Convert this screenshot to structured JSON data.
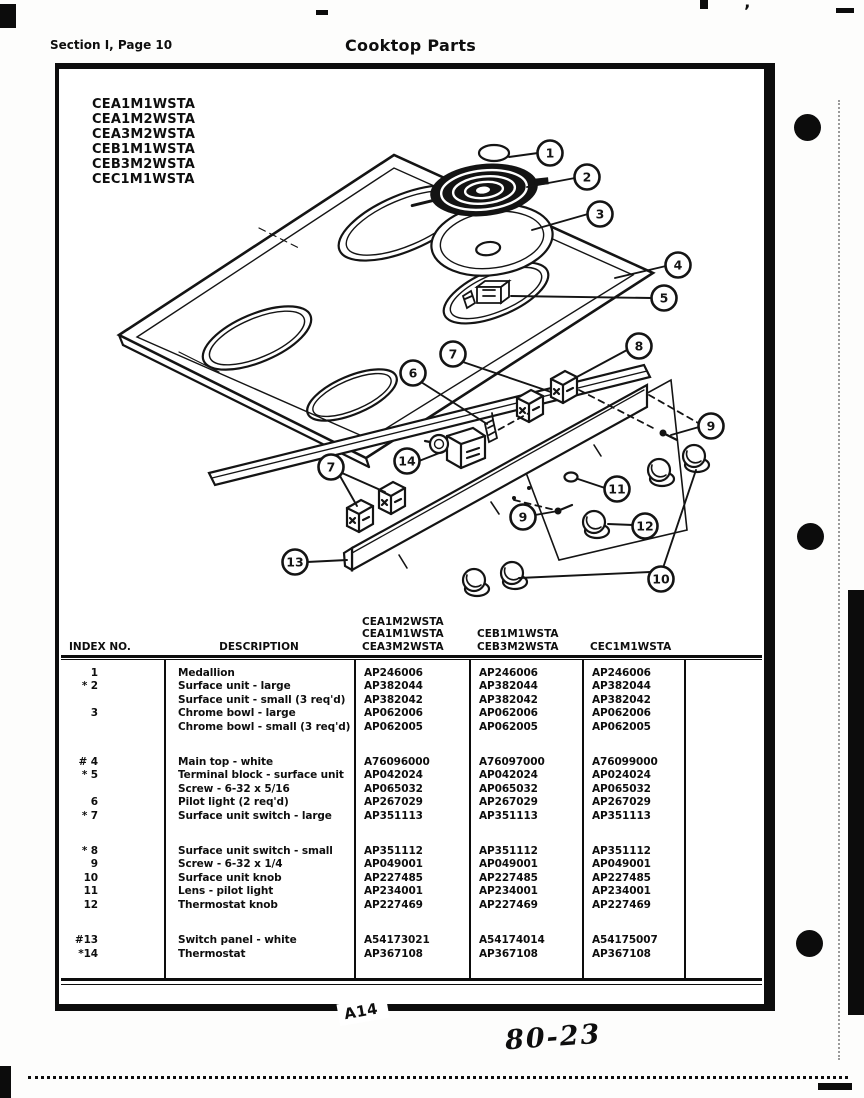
{
  "page": {
    "section_label": "Section I, Page 10",
    "title": "Cooktop Parts",
    "footer_label": "A14",
    "handwritten_note": "80-23"
  },
  "models": [
    "CEA1M1WSTA",
    "CEA1M2WSTA",
    "CEA3M2WSTA",
    "CEB1M1WSTA",
    "CEB3M2WSTA",
    "CEC1M1WSTA"
  ],
  "diagram": {
    "callouts": [
      {
        "label": "1"
      },
      {
        "label": "2"
      },
      {
        "label": "3"
      },
      {
        "label": "4"
      },
      {
        "label": "5"
      },
      {
        "label": "7"
      },
      {
        "label": "8"
      },
      {
        "label": "6"
      },
      {
        "label": "14"
      },
      {
        "label": "7"
      },
      {
        "label": "9"
      },
      {
        "label": "11"
      },
      {
        "label": "9"
      },
      {
        "label": "12"
      },
      {
        "label": "13"
      },
      {
        "label": "10"
      }
    ]
  },
  "table": {
    "headers": {
      "index": "INDEX NO.",
      "description": "DESCRIPTION",
      "col1_models": [
        "CEA1M2WSTA",
        "CEA1M1WSTA",
        "CEA3M2WSTA"
      ],
      "col2_models": [
        "CEB1M1WSTA",
        "CEB3M2WSTA"
      ],
      "col3_models": [
        "CEC1M1WSTA"
      ]
    },
    "groups": [
      {
        "rows": [
          {
            "index": "1",
            "description": "Medallion",
            "parts": [
              "AP246006",
              "AP246006",
              "AP246006"
            ]
          },
          {
            "index": "* 2",
            "description": "Surface unit - large",
            "parts": [
              "AP382044",
              "AP382044",
              "AP382044"
            ]
          },
          {
            "index": "",
            "description": "Surface unit - small (3 req'd)",
            "parts": [
              "AP382042",
              "AP382042",
              "AP382042"
            ]
          },
          {
            "index": "3",
            "description": "Chrome bowl - large",
            "parts": [
              "AP062006",
              "AP062006",
              "AP062006"
            ]
          },
          {
            "index": "",
            "description": "Chrome bowl - small (3 req'd)",
            "parts": [
              "AP062005",
              "AP062005",
              "AP062005"
            ]
          }
        ]
      },
      {
        "rows": [
          {
            "index": "# 4",
            "description": "Main top - white",
            "parts": [
              "A76096000",
              "A76097000",
              "A76099000"
            ]
          },
          {
            "index": "* 5",
            "description": "Terminal block - surface unit",
            "parts": [
              "AP042024",
              "AP042024",
              "AP024024"
            ]
          },
          {
            "index": "",
            "description": "Screw - 6-32 x 5/16",
            "parts": [
              "AP065032",
              "AP065032",
              "AP065032"
            ]
          },
          {
            "index": "6",
            "description": "Pilot light (2 req'd)",
            "parts": [
              "AP267029",
              "AP267029",
              "AP267029"
            ]
          },
          {
            "index": "* 7",
            "description": "Surface unit switch - large",
            "parts": [
              "AP351113",
              "AP351113",
              "AP351113"
            ]
          }
        ]
      },
      {
        "rows": [
          {
            "index": "* 8",
            "description": "Surface unit switch - small",
            "parts": [
              "AP351112",
              "AP351112",
              "AP351112"
            ]
          },
          {
            "index": "9",
            "description": "Screw - 6-32 x 1/4",
            "parts": [
              "AP049001",
              "AP049001",
              "AP049001"
            ]
          },
          {
            "index": "10",
            "description": "Surface unit knob",
            "parts": [
              "AP227485",
              "AP227485",
              "AP227485"
            ]
          },
          {
            "index": "11",
            "description": "Lens - pilot light",
            "parts": [
              "AP234001",
              "AP234001",
              "AP234001"
            ]
          },
          {
            "index": "12",
            "description": "Thermostat knob",
            "parts": [
              "AP227469",
              "AP227469",
              "AP227469"
            ]
          }
        ]
      },
      {
        "rows": [
          {
            "index": "#13",
            "description": "Switch panel - white",
            "parts": [
              "A54173021",
              "A54174014",
              "A54175007"
            ]
          },
          {
            "index": "*14",
            "description": "Thermostat",
            "parts": [
              "AP367108",
              "AP367108",
              "AP367108"
            ]
          }
        ]
      }
    ]
  }
}
